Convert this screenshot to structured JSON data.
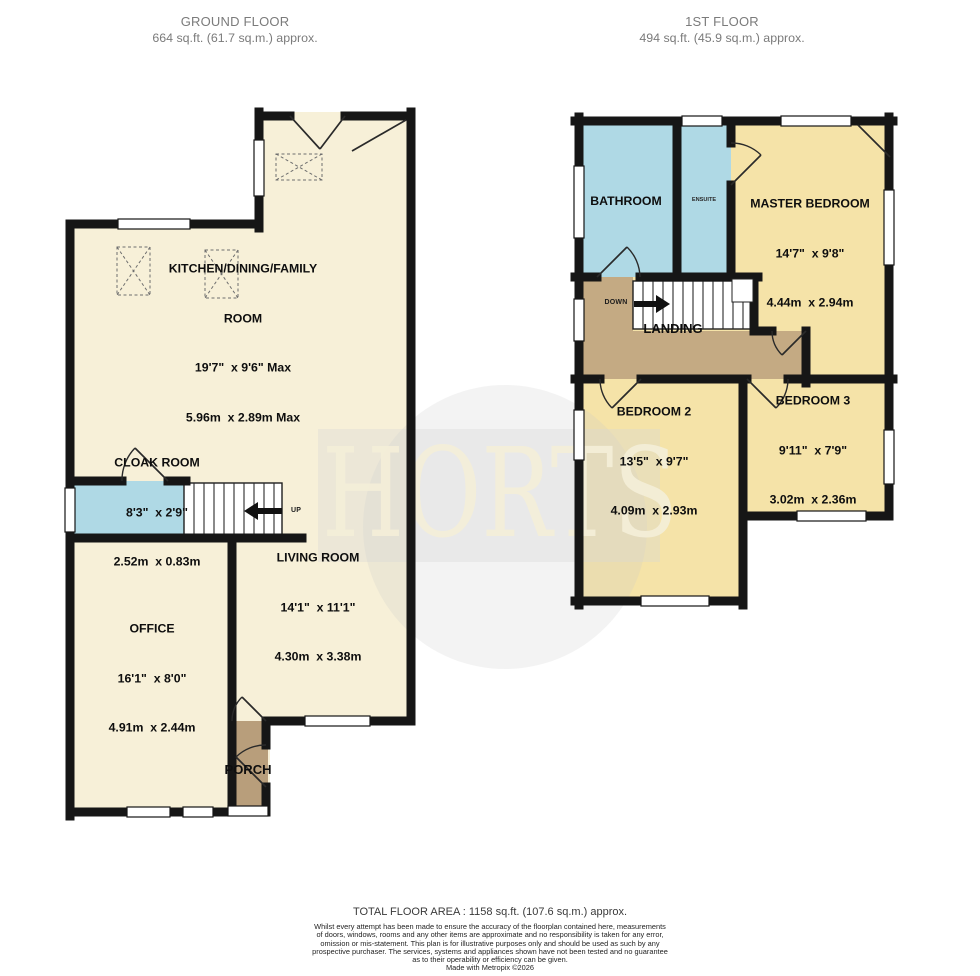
{
  "headers": {
    "ground": {
      "title": "GROUND FLOOR",
      "area": "664 sq.ft. (61.7 sq.m.) approx."
    },
    "first": {
      "title": "1ST FLOOR",
      "area": "494 sq.ft. (45.9 sq.m.) approx."
    }
  },
  "watermark": {
    "text": "HORTS"
  },
  "ground_rooms": {
    "kitchen": {
      "name": "KITCHEN/DINING/FAMILY",
      "name2": "ROOM",
      "imperial": "19'7\"  x 9'6\" Max",
      "metric": "5.96m  x 2.89m Max"
    },
    "cloak": {
      "name": "CLOAK ROOM",
      "imperial": "8'3\"  x 2'9\"",
      "metric": "2.52m  x 0.83m"
    },
    "living": {
      "name": "LIVING ROOM",
      "imperial": "14'1\"  x 11'1\"",
      "metric": "4.30m  x 3.38m"
    },
    "office": {
      "name": "OFFICE",
      "imperial": "16'1\"  x 8'0\"",
      "metric": "4.91m  x 2.44m"
    },
    "porch": {
      "name": "PORCH"
    },
    "stairs_label": "UP"
  },
  "first_rooms": {
    "bathroom": {
      "name": "BATHROOM"
    },
    "ensuite": {
      "name": "ENSUITE"
    },
    "master": {
      "name": "MASTER BEDROOM",
      "imperial": "14'7\"  x 9'8\"",
      "metric": "4.44m  x 2.94m"
    },
    "landing": {
      "name": "LANDING"
    },
    "bedroom2": {
      "name": "BEDROOM 2",
      "imperial": "13'5\"  x 9'7\"",
      "metric": "4.09m  x 2.93m"
    },
    "bedroom3": {
      "name": "BEDROOM 3",
      "imperial": "9'11\"  x 7'9\"",
      "metric": "3.02m  x 2.36m"
    },
    "stairs_label": "DOWN"
  },
  "footer": {
    "total": "TOTAL FLOOR AREA : 1158 sq.ft. (107.6 sq.m.) approx.",
    "disclaimer": [
      "Whilst every attempt has been made to ensure the accuracy of the floorplan contained here, measurements",
      "of doors, windows, rooms and any other items are approximate and no responsibility is taken for any error,",
      "omission or mis-statement. This plan is for illustrative purposes only and should be used as such by any",
      "prospective purchaser. The services, systems and appliances shown have not been tested and no guarantee",
      "as to their operability or efficiency can be given."
    ],
    "credit": "Made with Metropix ©2026"
  },
  "colors": {
    "room_cream": "#F7F0D8",
    "room_yellow": "#F5E3A8",
    "room_blue": "#AFD9E5",
    "landing_brown": "#C4AA83",
    "porch_brown": "#B89E7B",
    "wall": "#161616"
  }
}
